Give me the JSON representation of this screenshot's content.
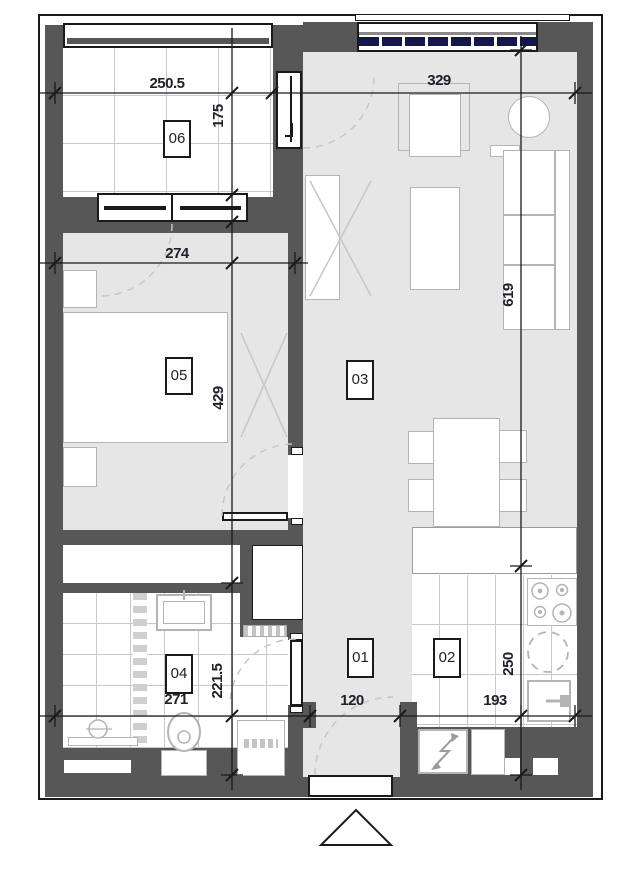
{
  "plan": {
    "type": "apartment-floor-plan",
    "rooms": [
      {
        "id": "room-01",
        "label": "01",
        "dimensions": {
          "width": "120"
        }
      },
      {
        "id": "room-02",
        "label": "02",
        "dimensions": {
          "width": "193",
          "depth": "250"
        }
      },
      {
        "id": "room-03",
        "label": "03",
        "dimensions": {
          "width": "329",
          "depth": "619"
        }
      },
      {
        "id": "room-04",
        "label": "04",
        "dimensions": {
          "width": "271",
          "depth": "221.5"
        }
      },
      {
        "id": "room-05",
        "label": "05",
        "dimensions": {
          "width": "274",
          "depth": "429"
        }
      },
      {
        "id": "room-06",
        "label": "06",
        "dimensions": {
          "width": "250.5",
          "depth": "175"
        }
      }
    ],
    "icons": {
      "north_marker": "hollow-triangle",
      "stove": "four-burner-cooktop",
      "kitchen_sink": "dashed-circle-sink",
      "electrical_panel": "lightning-bolt-arrow",
      "toilet": "toilet-top-view",
      "shower_drain": "circle-with-line"
    },
    "colors": {
      "wall": "#575757",
      "floor": "#e6e6e6",
      "furniture_outline": "#b4b4b4",
      "glazing": "#16164e",
      "dimension_text": "#202028",
      "line": "#1a1a1a"
    }
  }
}
